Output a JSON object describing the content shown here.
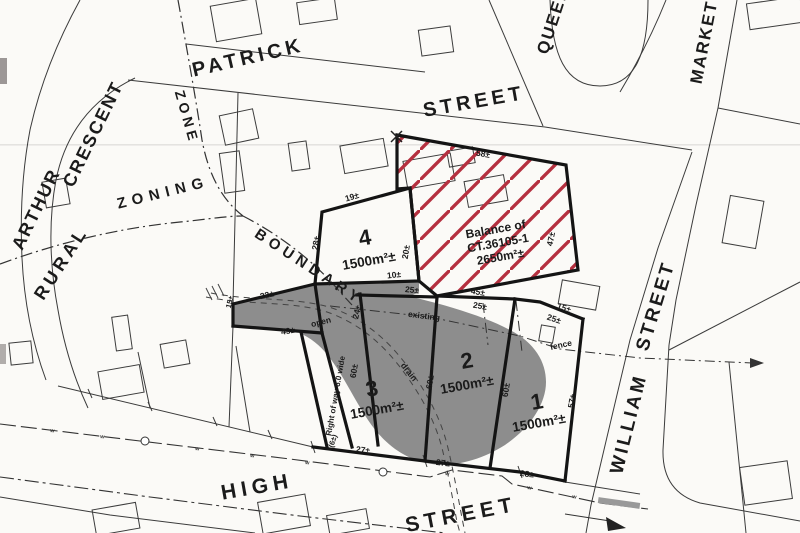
{
  "streets": {
    "patrick": "PATRICK",
    "patrick_street": "STREET",
    "queen": "QUEEN",
    "market": "MARKET",
    "william": "WILLIAM",
    "william_street": "STREET",
    "high": "HIGH",
    "high_street": "STREET",
    "arthur": "ARTHUR",
    "crescent": "CRESCENT"
  },
  "zoning": {
    "rural": "RURAL",
    "zone": "ZONE",
    "zoning": "ZONING",
    "boundary": "BOUNDARY"
  },
  "lots": [
    {
      "number": "4",
      "area": "1500m²±"
    },
    {
      "number": "3",
      "area": "1500m²±"
    },
    {
      "number": "2",
      "area": "1500m²±"
    },
    {
      "number": "1",
      "area": "1500m²±"
    }
  ],
  "balance_parcel": {
    "line1": "Balance of",
    "line2": "CT.36105-1",
    "line3": "2650m²±"
  },
  "features": {
    "open": "open",
    "existing": "existing",
    "drain": "drain",
    "fence": "fence",
    "right_of_way": "Right of way 6.0 wide",
    "water_marker": "w"
  },
  "dims": [
    {
      "id": "lot4-top",
      "label": "19±"
    },
    {
      "id": "lot4-left",
      "label": "28±"
    },
    {
      "id": "lot4-right",
      "label": "20±"
    },
    {
      "id": "lot4-bottom",
      "label": "10±"
    },
    {
      "id": "lot3-top",
      "label": "25±"
    },
    {
      "id": "balance-top",
      "label": "58±"
    },
    {
      "id": "balance-right",
      "label": "47±"
    },
    {
      "id": "balance-bottom",
      "label": "45±"
    },
    {
      "id": "lot2-top",
      "label": "25±"
    },
    {
      "id": "step-upper",
      "label": "15±"
    },
    {
      "id": "lot1-top",
      "label": "25±"
    },
    {
      "id": "lot1-east",
      "label": "57±"
    },
    {
      "id": "lot3-west",
      "label": "60±"
    },
    {
      "id": "lot3-east",
      "label": "60±"
    },
    {
      "id": "lot2-east",
      "label": "60±"
    },
    {
      "id": "lot3-nw",
      "label": "24±"
    },
    {
      "id": "strip-top",
      "label": "22±"
    },
    {
      "id": "strip-bottom",
      "label": "43±"
    },
    {
      "id": "strip-left",
      "label": "15±"
    },
    {
      "id": "lot3-front",
      "label": "27±"
    },
    {
      "id": "lot2-front",
      "label": "27±"
    },
    {
      "id": "lot1-front",
      "label": "28±"
    },
    {
      "id": "row-width",
      "label": "(6±)"
    }
  ],
  "colors": {
    "hatch": "#b5303f",
    "shade": "#8d8d8d",
    "ink": "#1b1b1b",
    "paper": "#fbfaf7"
  }
}
